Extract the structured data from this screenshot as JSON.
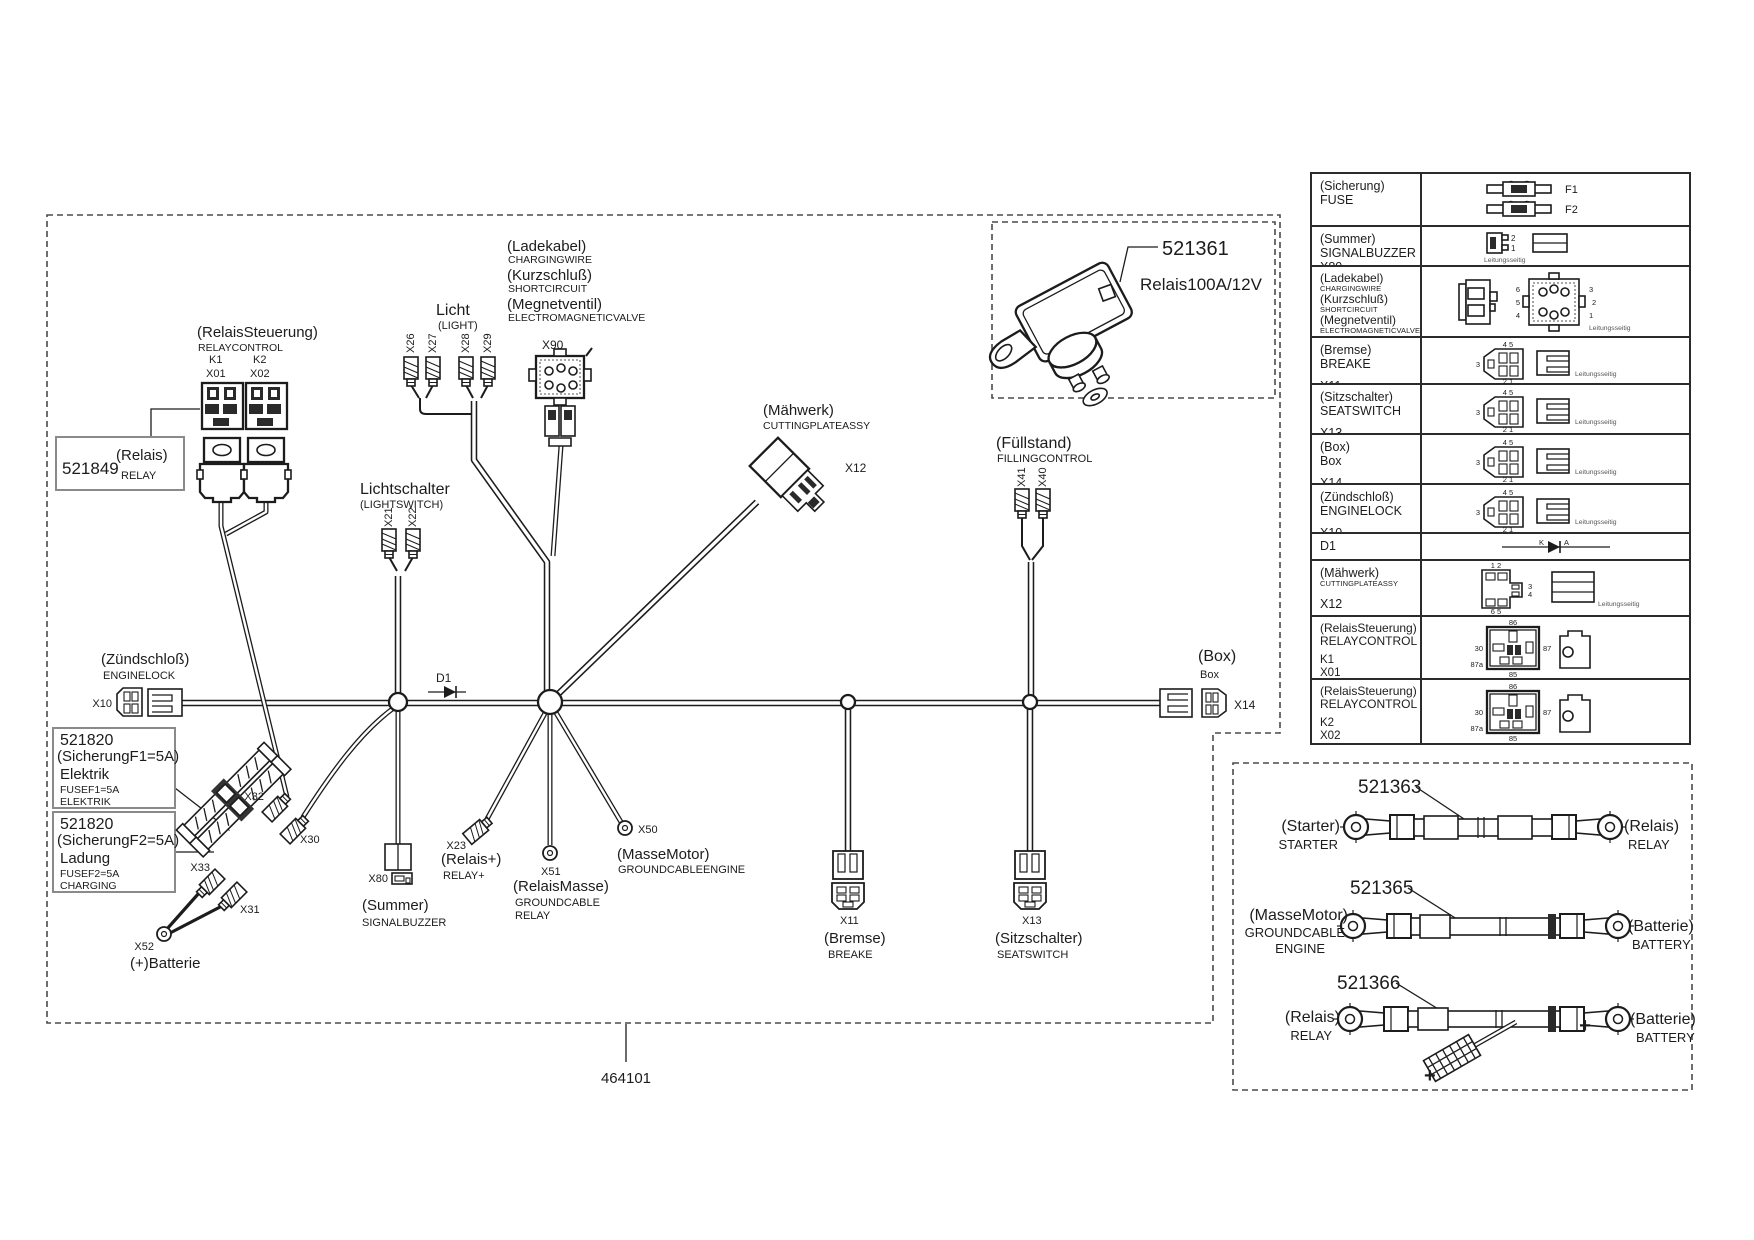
{
  "colors": {
    "ink": "#1c1c1c",
    "dash_border": "#4a4a4a",
    "table_border": "#2b2b2b"
  },
  "diagram": {
    "part_number": "464101",
    "relaycontrol": {
      "de": "(RelaisSteuerung)",
      "en": "RELAYCONTROL",
      "k1": "K1",
      "k2": "K2",
      "x01": "X01",
      "x02": "X02"
    },
    "relay_box": {
      "part": "521849",
      "de": "(Relais)",
      "en": "RELAY"
    },
    "light": {
      "de": "Licht",
      "en": "(LIGHT)",
      "c1": "X26",
      "c2": "X27",
      "c3": "X28",
      "c4": "X29"
    },
    "lightswitch": {
      "de": "Lichtschalter",
      "en": "(LIGHTSWITCH)",
      "c1": "X21",
      "c2": "X22"
    },
    "charging": {
      "de1": "(Ladekabel)",
      "en1": "CHARGINGWIRE",
      "de2": "(Kurzschluß)",
      "en2": "SHORTCIRCUIT",
      "de3": "(Megnetventil)",
      "en3": "ELECTROMAGNETICVALVE",
      "conn": "X90"
    },
    "cutting": {
      "de": "(Mähwerk)",
      "en": "CUTTINGPLATEASSY",
      "conn": "X12"
    },
    "filling": {
      "de": "(Füllstand)",
      "en": "FILLINGCONTROL",
      "c1": "X41",
      "c2": "X40"
    },
    "diode": "D1",
    "enginelock": {
      "de": "(Zündschloß)",
      "en": "ENGINELOCK",
      "conn": "X10"
    },
    "fuse1": {
      "part": "521820",
      "de": "(SicherungF1=5A)",
      "name": "Elektrik",
      "en1": "FUSEF1=5A",
      "en2": "ELEKTRIK"
    },
    "fuse2": {
      "part": "521820",
      "de": "(SicherungF2=5A)",
      "name": "Ladung",
      "en1": "FUSEF2=5A",
      "en2": "CHARGING"
    },
    "cluster": {
      "x32": "X32",
      "x30": "X30",
      "x33": "X33",
      "x31": "X31",
      "x52": "X52",
      "battery": "(+)Batterie"
    },
    "buzzer": {
      "conn": "X80",
      "de": "(Summer)",
      "en": "SIGNALBUZZER"
    },
    "relay_plus": {
      "conn": "X23",
      "de": "(Relais+)",
      "en": "RELAY+"
    },
    "relay_ground": {
      "conn": "X51",
      "de": "(RelaisMasse)",
      "en1": "GROUNDCABLE",
      "en2": "RELAY"
    },
    "engine_ground": {
      "conn": "X50",
      "de": "(MasseMotor)",
      "en": "GROUNDCABLEENGINE"
    },
    "brake": {
      "conn": "X11",
      "de": "(Bremse)",
      "en": "BREAKE"
    },
    "seat": {
      "conn": "X13",
      "de": "(Sitzschalter)",
      "en": "SEATSWITCH"
    },
    "box": {
      "de": "(Box)",
      "en": "Box",
      "conn": "X14"
    },
    "relay100": {
      "part": "521361",
      "label": "Relais100A/12V"
    }
  },
  "table": {
    "rows": [
      {
        "l1": "(Sicherung)",
        "l2": "FUSE"
      },
      {
        "l1": "(Summer)",
        "l2": "SIGNALBUZZER",
        "x": "X80"
      },
      {
        "de1": "(Ladekabel)",
        "en1": "CHARGINGWIRE",
        "de2": "(Kurzschluß)",
        "en2": "SHORTCIRCUIT",
        "de3": "(Megnetventil)",
        "en3": "ELECTROMAGNETICVALVE",
        "x": "X90"
      },
      {
        "l1": "(Bremse)",
        "l2": "BREAKE",
        "x": "X11"
      },
      {
        "l1": "(Sitzschalter)",
        "l2": "SEATSWITCH",
        "x": "X13"
      },
      {
        "l1": "(Box)",
        "l2": "Box",
        "x": "X14"
      },
      {
        "l1": "(Zündschloß)",
        "l2": "ENGINELOCK",
        "x": "X10"
      },
      {
        "l1": "D1"
      },
      {
        "l1": "(Mähwerk)",
        "l2": "CUTTINGPLATEASSY",
        "x": "X12"
      },
      {
        "l1": "(RelaisSteuerung)",
        "l2": "RELAYCONTROL",
        "k": "K1",
        "x": "X01"
      },
      {
        "l1": "(RelaisSteuerung)",
        "l2": "RELAYCONTROL",
        "k": "K2",
        "x": "X02"
      }
    ]
  },
  "cables": {
    "c1": {
      "part": "521363",
      "left_de": "(Starter)",
      "left_en": "STARTER",
      "right_de": "(Relais)",
      "right_en": "RELAY"
    },
    "c2": {
      "part": "521365",
      "left_de": "(MasseMotor)",
      "left_en1": "GROUNDCABLE",
      "left_en2": "ENGINE",
      "right_de": "(Batterie)",
      "right_en": "BATTERY"
    },
    "c3": {
      "part": "521366",
      "left_de": "(Relais)",
      "left_en": "RELAY",
      "right_de": "(Batterie)",
      "right_en": "BATTERY",
      "plus": "+"
    }
  },
  "icons": {
    "wire_side_note": "Leitungsseitig",
    "fuse": {
      "f1": "F1",
      "f2": "F2"
    },
    "buzzer": {
      "p2": "2",
      "p1": "1"
    },
    "x90": {
      "p1": "1",
      "p2": "2",
      "p3": "3",
      "p4": "4",
      "p5": "5",
      "p6": "6"
    },
    "conn5": {
      "top": "4 5",
      "left": "3",
      "bottom": "2 1"
    },
    "diode": {
      "k": "K",
      "a": "A"
    },
    "x12": {
      "top": "1 2",
      "r1": "3",
      "r2": "4",
      "bottom": "6 5"
    },
    "relay": {
      "t": "86",
      "l": "30",
      "r": "87",
      "bl": "87a",
      "b": "85"
    }
  }
}
